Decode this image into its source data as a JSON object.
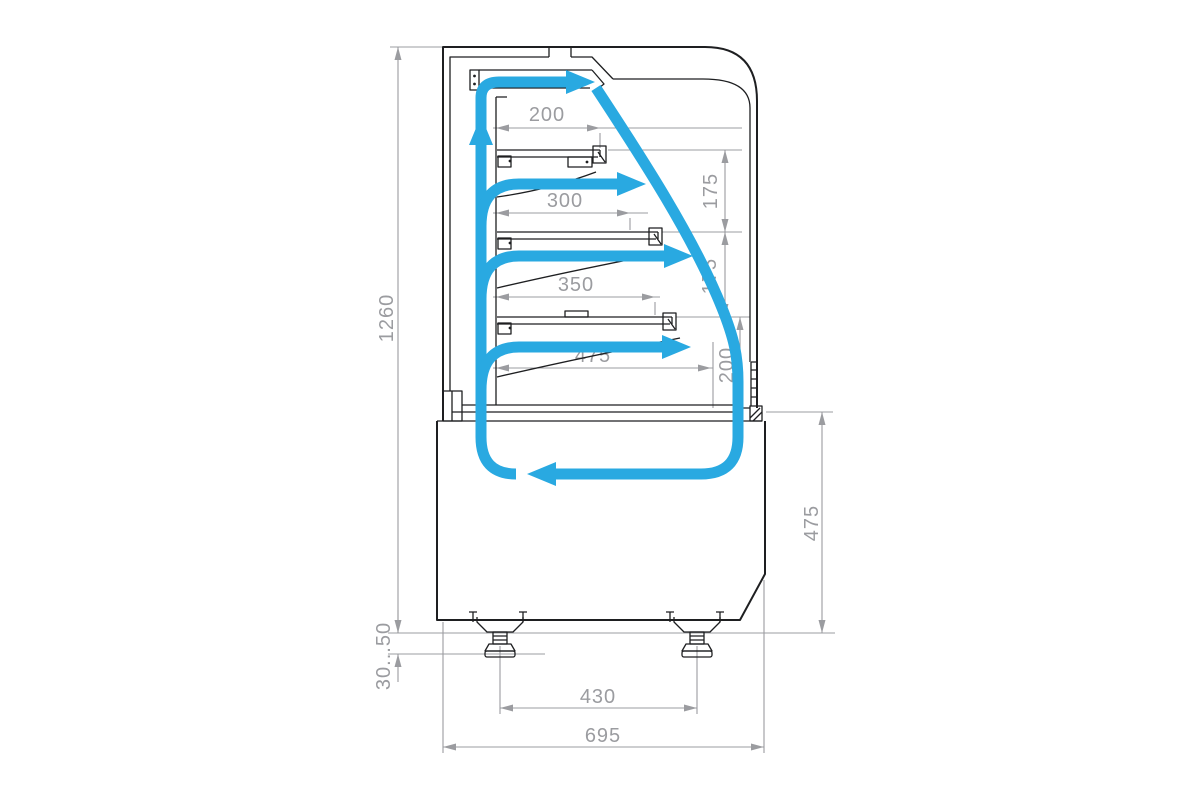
{
  "colors": {
    "airflow": "#29A9E1",
    "linework": "#1e1f21",
    "dimension": "#9B9CA0",
    "background": "#ffffff"
  },
  "dimensions": {
    "shelf1_width": "200",
    "shelf1_to_shelf2": "175",
    "shelf2_width": "300",
    "shelf2_to_shelf3": "175",
    "shelf3_width": "350",
    "shelf3_to_deck": "200",
    "deck_width": "475",
    "overall_height": "1260",
    "base_height": "475",
    "leg_adjustment": "30...50",
    "leg_spacing": "430",
    "overall_depth": "695"
  }
}
